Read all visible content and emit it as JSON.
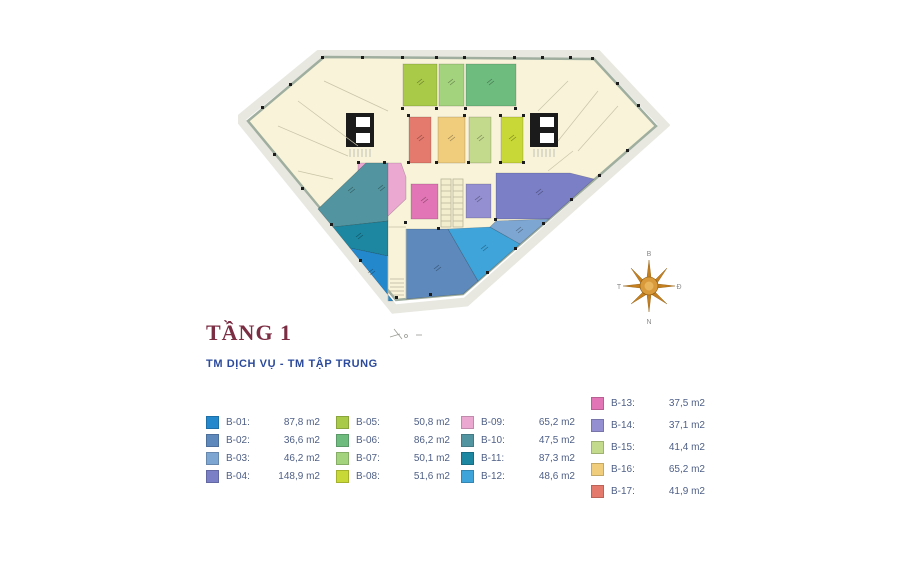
{
  "title": "TẦNG 1",
  "subtitle": "TM DỊCH VỤ - TM TẬP TRUNG",
  "compass": {
    "north": "B",
    "east": "Đ",
    "south": "N",
    "west": "T"
  },
  "legend": {
    "items": [
      {
        "label": "B-01:",
        "value": "87,8 m2",
        "color": "#2488cd"
      },
      {
        "label": "B-02:",
        "value": "36,6 m2",
        "color": "#5d89bd"
      },
      {
        "label": "B-03:",
        "value": "46,2 m2",
        "color": "#7ea6d2"
      },
      {
        "label": "B-04:",
        "value": "148,9 m2",
        "color": "#7a7fc6"
      },
      {
        "label": "B-05:",
        "value": "50,8 m2",
        "color": "#a9ca49"
      },
      {
        "label": "B-06:",
        "value": "86,2 m2",
        "color": "#6fbc7f"
      },
      {
        "label": "B-07:",
        "value": "50,1 m2",
        "color": "#a4d37d"
      },
      {
        "label": "B-08:",
        "value": "51,6 m2",
        "color": "#c8d836"
      },
      {
        "label": "B-09:",
        "value": "65,2 m2",
        "color": "#eba9d2"
      },
      {
        "label": "B-10:",
        "value": "47,5 m2",
        "color": "#5295a0"
      },
      {
        "label": "B-11:",
        "value": "87,3 m2",
        "color": "#1d87a2"
      },
      {
        "label": "B-12:",
        "value": "48,6 m2",
        "color": "#3fa4da"
      },
      {
        "label": "B-13:",
        "value": "37,5 m2",
        "color": "#e275b5"
      },
      {
        "label": "B-14:",
        "value": "37,1 m2",
        "color": "#938fd0"
      },
      {
        "label": "B-15:",
        "value": "41,4 m2",
        "color": "#c3d98c"
      },
      {
        "label": "B-16:",
        "value": "65,2 m2",
        "color": "#f0cd7d"
      },
      {
        "label": "B-17:",
        "value": "41,9 m2",
        "color": "#e4796d"
      }
    ]
  }
}
